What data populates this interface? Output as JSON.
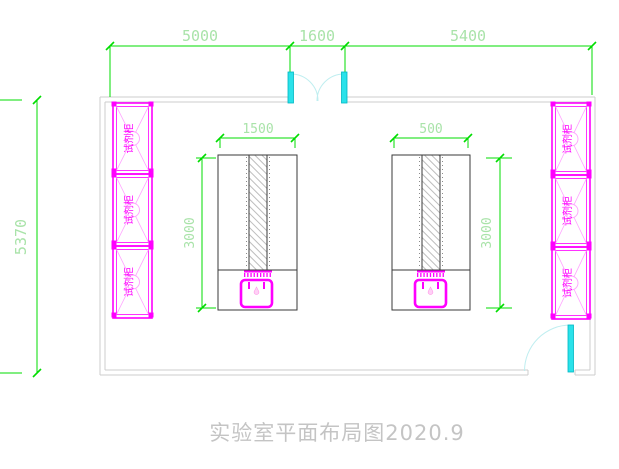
{
  "drawing": {
    "title": "实验室平面布局图2020.9",
    "type_note": "laboratory floor plan"
  },
  "dimensions": {
    "top_left_span": "5000",
    "top_door_span": "1600",
    "top_right_span": "5400",
    "left_overall": "5370",
    "left_bench_width": "1500",
    "left_bench_depth": "3000",
    "right_bench_width": "500",
    "right_bench_depth": "3000"
  },
  "cabinets": {
    "left": [
      "试剂柜",
      "试剂柜",
      "试剂柜"
    ],
    "right": [
      "试剂柜",
      "试剂柜",
      "试剂柜"
    ]
  },
  "colors": {
    "dimension_line": "#00dd00",
    "dimension_text": "#a9e3a9",
    "cabinet": "#ff00ff",
    "cabinet_light": "#ffa3ff",
    "door": "#2ae2ea",
    "door_arc": "#bfeef0",
    "wall": "#cccccc",
    "bench_outline": "#3a3a3a",
    "title_text": "#c4c4c4"
  }
}
